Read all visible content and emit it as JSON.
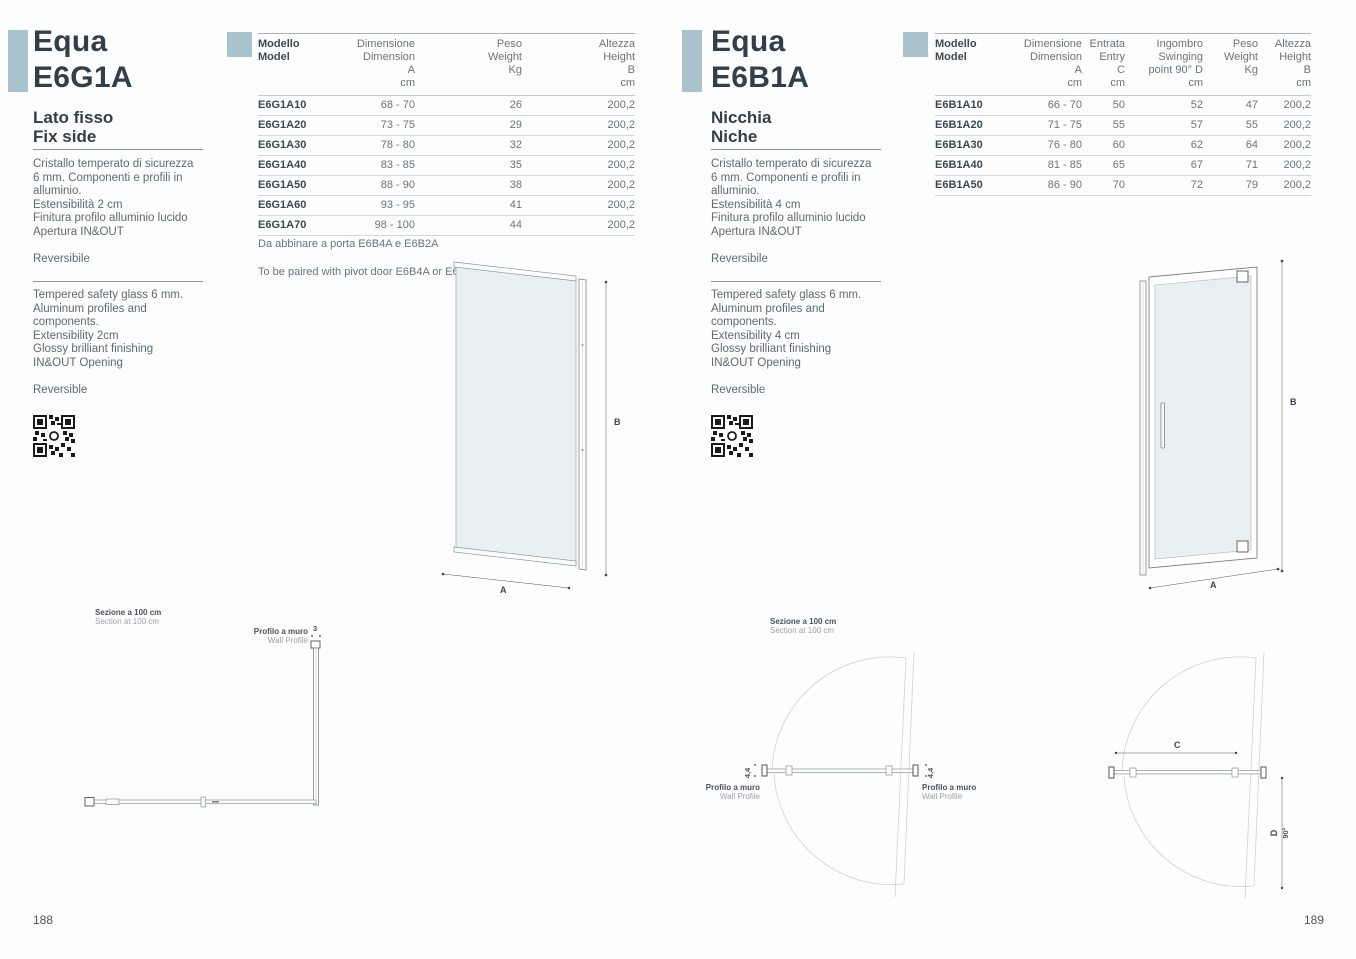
{
  "accent_color": "#a9c3cd",
  "left": {
    "page_number": "188",
    "title_line1": "Equa",
    "title_line2": "E6G1A",
    "subtitle_line1": "Lato fisso",
    "subtitle_line2": "Fix side",
    "description_it": [
      "Cristallo temperato di sicurezza",
      "6 mm. Componenti e profili in",
      "alluminio.",
      "Estensibilità 2 cm",
      "Finitura profilo alluminio lucido",
      "Apertura IN&OUT"
    ],
    "reversible_it": "Reversibile",
    "description_en": [
      "Tempered safety glass 6 mm.",
      "Aluminum profiles and",
      "components.",
      "Extensibility 2cm",
      "Glossy brilliant finishing",
      "IN&OUT Opening"
    ],
    "reversible_en": "Reversible",
    "table": {
      "headers": {
        "model": [
          "Modello",
          "Model"
        ],
        "dimension": [
          "Dimensione",
          "Dimension",
          "A",
          "cm"
        ],
        "weight": [
          "Peso",
          "Weight",
          "Kg"
        ],
        "height": [
          "Altezza",
          "Height",
          "B",
          "cm"
        ]
      },
      "rows": [
        [
          "E6G1A10",
          "68 - 70",
          "26",
          "200,2"
        ],
        [
          "E6G1A20",
          "73 - 75",
          "29",
          "200,2"
        ],
        [
          "E6G1A30",
          "78 - 80",
          "32",
          "200,2"
        ],
        [
          "E6G1A40",
          "83 - 85",
          "35",
          "200,2"
        ],
        [
          "E6G1A50",
          "88 - 90",
          "38",
          "200,2"
        ],
        [
          "E6G1A60",
          "93 - 95",
          "41",
          "200,2"
        ],
        [
          "E6G1A70",
          "98 - 100",
          "44",
          "200,2"
        ]
      ],
      "note_it": "Da abbinare a porta E6B4A e E6B2A",
      "note_en": "To be paired with pivot door E6B4A or E6B2A"
    },
    "diagram": {
      "width_label": "A",
      "height_label": "B"
    },
    "section": {
      "title_it": "Sezione a 100 cm",
      "title_en": "Section at 100 cm",
      "wall_profile_it": "Profilo a muro",
      "wall_profile_en": "Wall Profile",
      "profile_dim": "3"
    }
  },
  "right": {
    "page_number": "189",
    "title_line1": "Equa",
    "title_line2": "E6B1A",
    "subtitle_line1": "Nicchia",
    "subtitle_line2": "Niche",
    "description_it": [
      "Cristallo temperato di sicurezza",
      "6 mm. Componenti e profili in",
      "alluminio.",
      "Estensibilità 4 cm",
      "Finitura profilo alluminio lucido",
      "Apertura IN&OUT"
    ],
    "reversible_it": "Reversibile",
    "description_en": [
      "Tempered safety glass 6 mm.",
      "Aluminum profiles and",
      "components.",
      "Extensibility 4 cm",
      "Glossy brilliant finishing",
      "IN&OUT Opening"
    ],
    "reversible_en": "Reversible",
    "table": {
      "headers": {
        "model": [
          "Modello",
          "Model"
        ],
        "dimension": [
          "Dimensione",
          "Dimension",
          "A",
          "cm"
        ],
        "entry": [
          "Entrata",
          "Entry",
          "C",
          "cm"
        ],
        "swinging": [
          "Ingombro",
          "Swinging",
          "point 90° D",
          "cm"
        ],
        "weight": [
          "Peso",
          "Weight",
          "Kg"
        ],
        "height": [
          "Altezza",
          "Height",
          "B",
          "cm"
        ]
      },
      "rows": [
        [
          "E6B1A10",
          "66 - 70",
          "50",
          "52",
          "47",
          "200,2"
        ],
        [
          "E6B1A20",
          "71 - 75",
          "55",
          "57",
          "55",
          "200,2"
        ],
        [
          "E6B1A30",
          "76 - 80",
          "60",
          "62",
          "64",
          "200,2"
        ],
        [
          "E6B1A40",
          "81 - 85",
          "65",
          "67",
          "71",
          "200,2"
        ],
        [
          "E6B1A50",
          "86 - 90",
          "70",
          "72",
          "79",
          "200,2"
        ]
      ]
    },
    "diagram": {
      "width_label": "A",
      "height_label": "B"
    },
    "section_niche": {
      "title_it": "Sezione a 100 cm",
      "title_en": "Section at 100 cm",
      "wall_profile_it": "Profilo a muro",
      "wall_profile_en": "Wall Profile",
      "extensibility_dim": "4,4"
    },
    "section_swing": {
      "entry_label": "C",
      "swing_label": "D",
      "angle_label": "90°"
    }
  }
}
